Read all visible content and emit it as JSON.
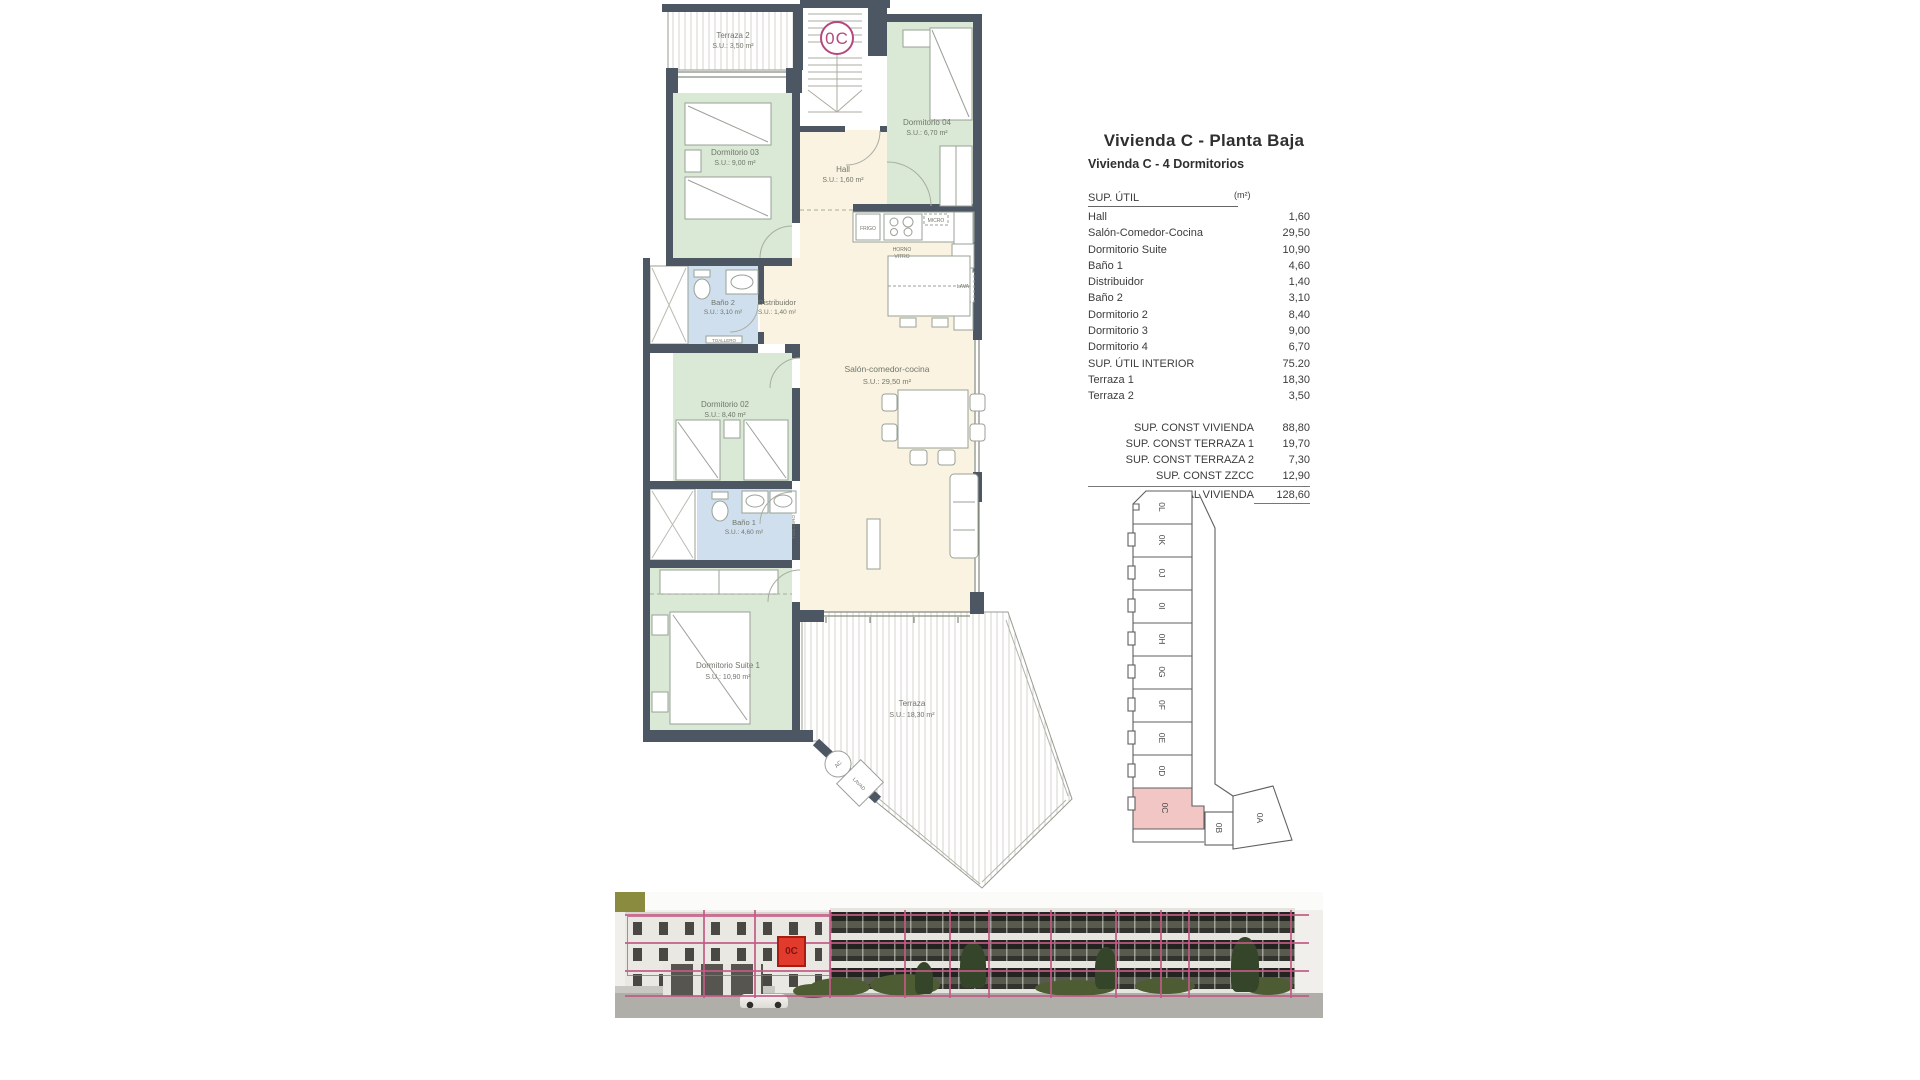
{
  "title_block": {
    "title": "Vivienda C - Planta Baja",
    "subtitle": "Vivienda C - 4 Dormitorios"
  },
  "area_table": {
    "header_label": "SUP. ÚTIL",
    "header_unit": "(m²)",
    "rows": [
      {
        "label": "Hall",
        "value": "1,60"
      },
      {
        "label": "Salón-Comedor-Cocina",
        "value": "29,50"
      },
      {
        "label": "Dormitorio Suite",
        "value": "10,90"
      },
      {
        "label": "Baño 1",
        "value": "4,60"
      },
      {
        "label": "Distribuidor",
        "value": "1,40"
      },
      {
        "label": "Baño 2",
        "value": "3,10"
      },
      {
        "label": "Dormitorio 2",
        "value": "8,40"
      },
      {
        "label": "Dormitorio 3",
        "value": "9,00"
      },
      {
        "label": "Dormitorio 4",
        "value": "6,70"
      },
      {
        "label": "SUP. ÚTIL INTERIOR",
        "value": "75.20"
      },
      {
        "label": "Terraza 1",
        "value": "18,30"
      },
      {
        "label": "Terraza 2",
        "value": "3,50"
      }
    ],
    "summary_rows": [
      {
        "label": "SUP. CONST VIVIENDA",
        "value": "88,80"
      },
      {
        "label": "SUP. CONST TERRAZA 1",
        "value": "19,70"
      },
      {
        "label": "SUP. CONST TERRAZA 2",
        "value": "7,30"
      },
      {
        "label": "SUP. CONST ZZCC",
        "value": "12,90"
      }
    ],
    "total_row": {
      "label": "TOTAL VIVIENDA",
      "value": "128,60"
    }
  },
  "floor_plan": {
    "unit_badge": "0C",
    "rooms": {
      "terraza2": {
        "name": "Terraza 2",
        "area": "S.U.: 3,50 m²"
      },
      "dormitorio04": {
        "name": "Dormitorio 04",
        "area": "S.U.: 6,70 m²"
      },
      "dormitorio03": {
        "name": "Dormitorio 03",
        "area": "S.U.: 9,00 m²"
      },
      "hall": {
        "name": "Hall",
        "area": "S.U.: 1,60 m²"
      },
      "bano2": {
        "name": "Baño 2",
        "area": "S.U.: 3,10 m²"
      },
      "distribuidor": {
        "name": "Distribuidor",
        "area": "S.U.: 1,40 m²"
      },
      "dormitorio02": {
        "name": "Dormitorio 02",
        "area": "S.U.: 8,40 m²"
      },
      "salon": {
        "name": "Salón-comedor-cocina",
        "area": "S.U.: 29,50 m²"
      },
      "bano1": {
        "name": "Baño 1",
        "area": "S.U.: 4,60 m²"
      },
      "suite": {
        "name": "Dormitorio Suite 1",
        "area": "S.U.: 10,90 m²"
      },
      "terraza1": {
        "name": "Terraza",
        "area": "S.U.: 18,30 m²"
      }
    },
    "fixtures": {
      "frigo": "FRIGO",
      "micro": "MICRO",
      "horno": "HORNO",
      "vitro": "VITRO",
      "lava": "LAVA",
      "toallero_b1": "TOALLERO",
      "toallero_b2": "TOALLERO",
      "ac": "AC",
      "lavadero": "LAVAD"
    }
  },
  "key_plan": {
    "units": [
      "0L",
      "0K",
      "0J",
      "0I",
      "0H",
      "0G",
      "0F",
      "0E",
      "0D",
      "0C",
      "0B",
      "0A"
    ],
    "highlighted_unit": "0C"
  },
  "photo": {
    "marker_label": "0C"
  },
  "colors": {
    "accent_pink": "#b5487e",
    "overlay_pink": "#c25a86",
    "highlight_red": "#e23b2e",
    "wall": "#4d5663",
    "room_green": "#d9e9d5",
    "room_blue": "#d0dfee",
    "room_cream": "#faf3e2",
    "keyplan_pink": "#f2c6c4"
  }
}
